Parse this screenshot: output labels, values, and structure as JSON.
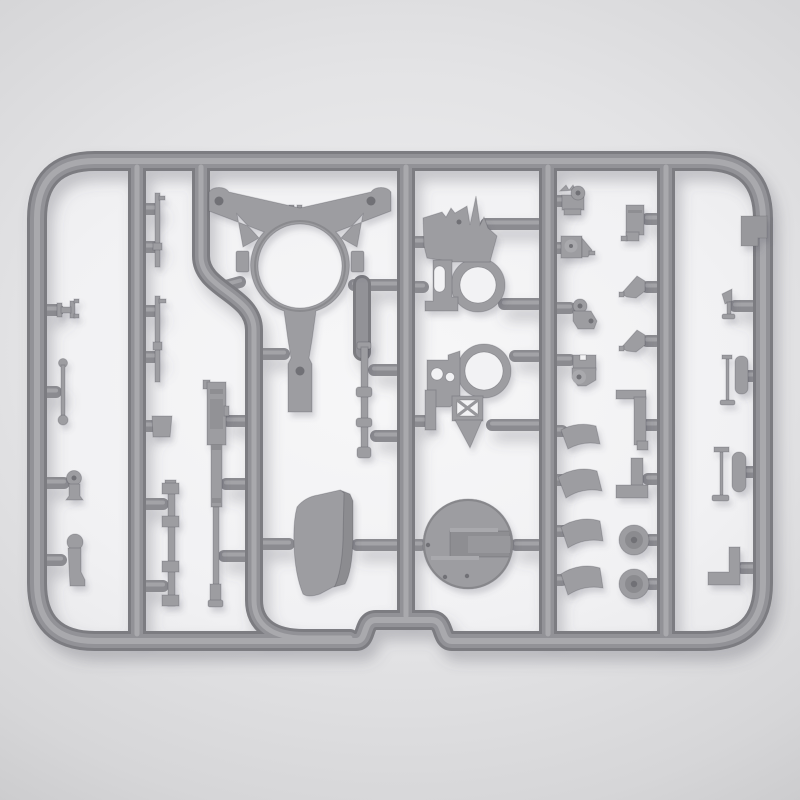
{
  "meta": {
    "description": "Product photo of a gray injection-molded scale-model sprue (parts tree) with machine-gun mount components",
    "visible_text": ""
  },
  "colors": {
    "background_outer_dark": "#c6c6c8",
    "background_outer_mid": "#e3e3e5",
    "background_outer_light": "#f0f0f1",
    "background_inner": "#f2f2f4",
    "plastic_base": "#9d9da1",
    "plastic_light": "#a9a9ad",
    "plastic_dark": "#8b8b90",
    "plastic_deep": "#7c7c81",
    "plastic_hole": "#717176"
  },
  "sprue": {
    "frame": {
      "label": "rectangular sprue frame with rounded corners and bottom notch"
    },
    "runners": [
      {
        "id": "runner-1",
        "label": "left inner runner"
      },
      {
        "id": "runner-2",
        "label": "bent runner around tripod frame"
      },
      {
        "id": "runner-3",
        "label": "center runner"
      },
      {
        "id": "runner-4",
        "label": "center-right runner"
      },
      {
        "id": "runner-5",
        "label": "right inner runner"
      }
    ],
    "parts": [
      {
        "id": "tripod-top-frame",
        "label": "large triangular mount frame with central ring"
      },
      {
        "id": "cradle-bracket-upper",
        "label": "gun cradle side bracket with ring and spikes"
      },
      {
        "id": "cradle-bracket-lower",
        "label": "gun cradle side bracket with ring and cross-braced frame"
      },
      {
        "id": "turntable-disc",
        "label": "large circular base disc with slot"
      },
      {
        "id": "armor-shield",
        "label": "curved armor shield plate"
      },
      {
        "id": "machine-gun",
        "label": "machine gun body with barrel"
      },
      {
        "id": "flanged-axle",
        "label": "axle rod with square flanges"
      },
      {
        "id": "elevation-column",
        "label": "ringed elevation rod"
      },
      {
        "id": "pin-rod-upper",
        "label": "thin pin rod"
      },
      {
        "id": "pin-rod-lower",
        "label": "thin pin rod"
      },
      {
        "id": "square-block",
        "label": "small square block"
      },
      {
        "id": "spool-clamp",
        "label": "small spool clamp"
      },
      {
        "id": "ball-end-link",
        "label": "link rod with ball ends"
      },
      {
        "id": "grip-bracket",
        "label": "small grip with eye"
      },
      {
        "id": "pivot-post",
        "label": "small pivot post"
      },
      {
        "id": "eye-bracket-1",
        "label": "small eye bracket"
      },
      {
        "id": "eye-bracket-2",
        "label": "small wedge bracket with boss"
      },
      {
        "id": "eye-bracket-3",
        "label": "small angled bracket with boss"
      },
      {
        "id": "eye-bracket-4",
        "label": "small notched bracket with boss"
      },
      {
        "id": "ammo-box",
        "label": "small rectangular box"
      },
      {
        "id": "corner-wedge-1",
        "label": "corner wedge"
      },
      {
        "id": "corner-wedge-2",
        "label": "corner wedge"
      },
      {
        "id": "angle-bracket-upper",
        "label": "angle bracket"
      },
      {
        "id": "angle-bracket-lower",
        "label": "angle bracket"
      },
      {
        "id": "seat-segment-1",
        "label": "curved segment"
      },
      {
        "id": "seat-segment-2",
        "label": "curved segment"
      },
      {
        "id": "seat-segment-3",
        "label": "curved segment"
      },
      {
        "id": "seat-segment-4",
        "label": "curved segment"
      },
      {
        "id": "hub-disc-1",
        "label": "small hub disc"
      },
      {
        "id": "hub-disc-2",
        "label": "small hub disc"
      },
      {
        "id": "edge-plate",
        "label": "stepped edge plate"
      },
      {
        "id": "flag-pin",
        "label": "small flag pin"
      },
      {
        "id": "tool-rod-upper",
        "label": "grip bar with thin rod"
      },
      {
        "id": "tool-rod-lower",
        "label": "grip bar with thin rod"
      },
      {
        "id": "corner-angle-right",
        "label": "L-shaped corner angle"
      }
    ]
  }
}
